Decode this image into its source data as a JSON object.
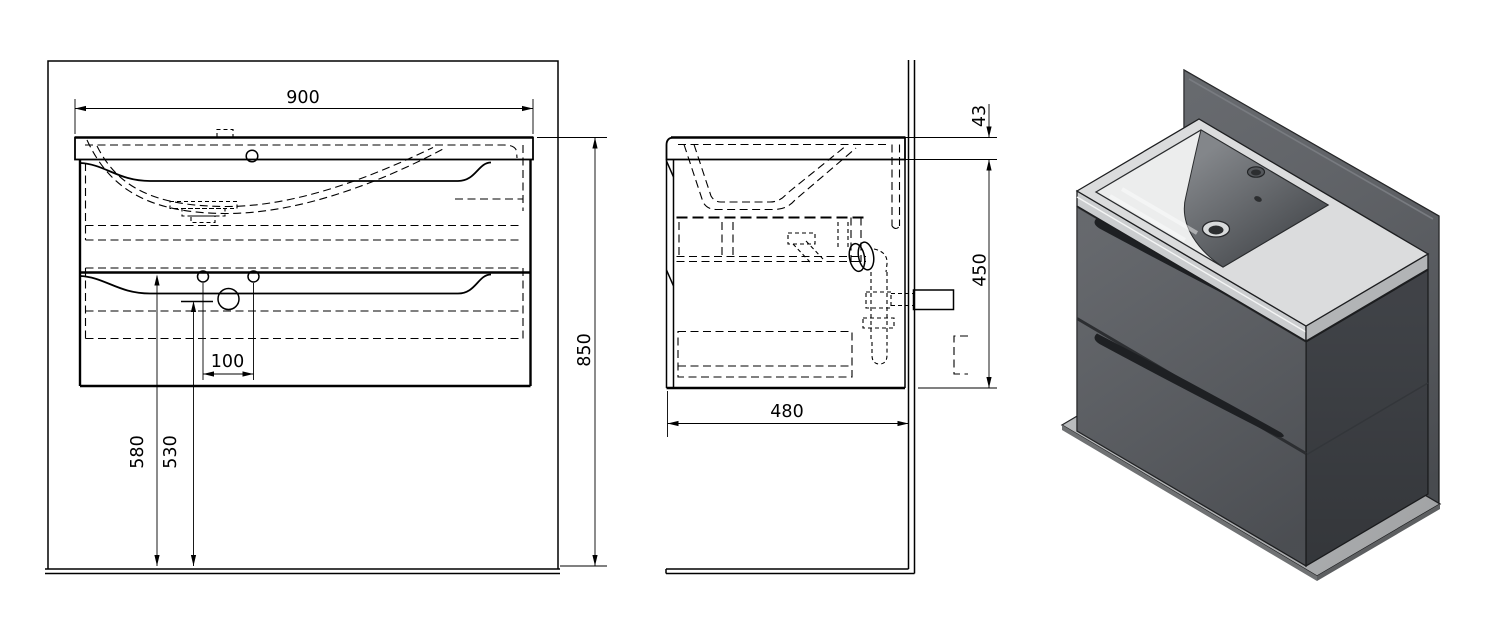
{
  "views": {
    "front": {
      "name": "front elevation",
      "dimensions": {
        "width": "900",
        "overall_height": "850",
        "drain_hole_spacing": "100",
        "drawer_top_height": "580",
        "drain_height": "530"
      }
    },
    "side": {
      "name": "side section",
      "dimensions": {
        "depth": "480",
        "cabinet_height": "450",
        "worktop_thickness": "43"
      }
    },
    "iso": {
      "name": "3d render"
    }
  },
  "colors": {
    "line": "#000000",
    "wall_panel": "#56595e",
    "floor_panel": "#b3b5b7",
    "floor_edge": "#6f7173",
    "cabinet_front": "#55585d",
    "cabinet_side": "#43464b",
    "recess": "#1e2023",
    "ceramic_top": "#dbdcdd",
    "ceramic_front_edge": "#cbcdcf",
    "ceramic_side_edge": "#b2b4b6",
    "basin_floor": "#eceded",
    "basin_wall": "#55585c",
    "hole_dark": "#2c2e30"
  }
}
